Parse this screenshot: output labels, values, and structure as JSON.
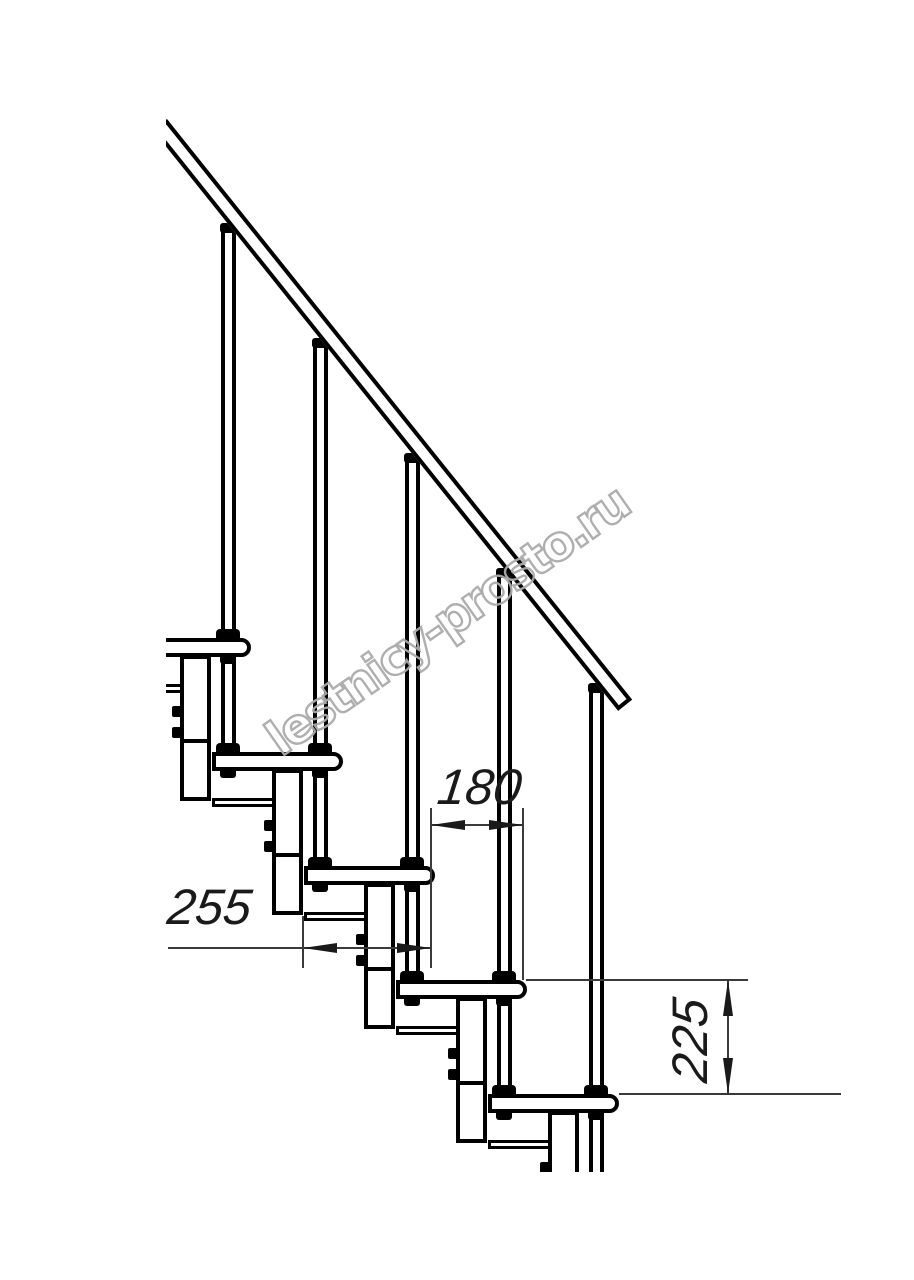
{
  "drawing": {
    "watermark_text": "lestnicy-prosto.ru",
    "steps_count": 5,
    "colors": {
      "line": "#000000",
      "thin_line": "#3a3a3a",
      "watermark_stroke": "#ababab",
      "background": "#ffffff"
    },
    "dims": {
      "run_180": {
        "value": "180",
        "orientation": "horizontal"
      },
      "depth_255": {
        "value": "255",
        "orientation": "horizontal"
      },
      "rise_225": {
        "value": "225",
        "orientation": "vertical"
      }
    }
  }
}
